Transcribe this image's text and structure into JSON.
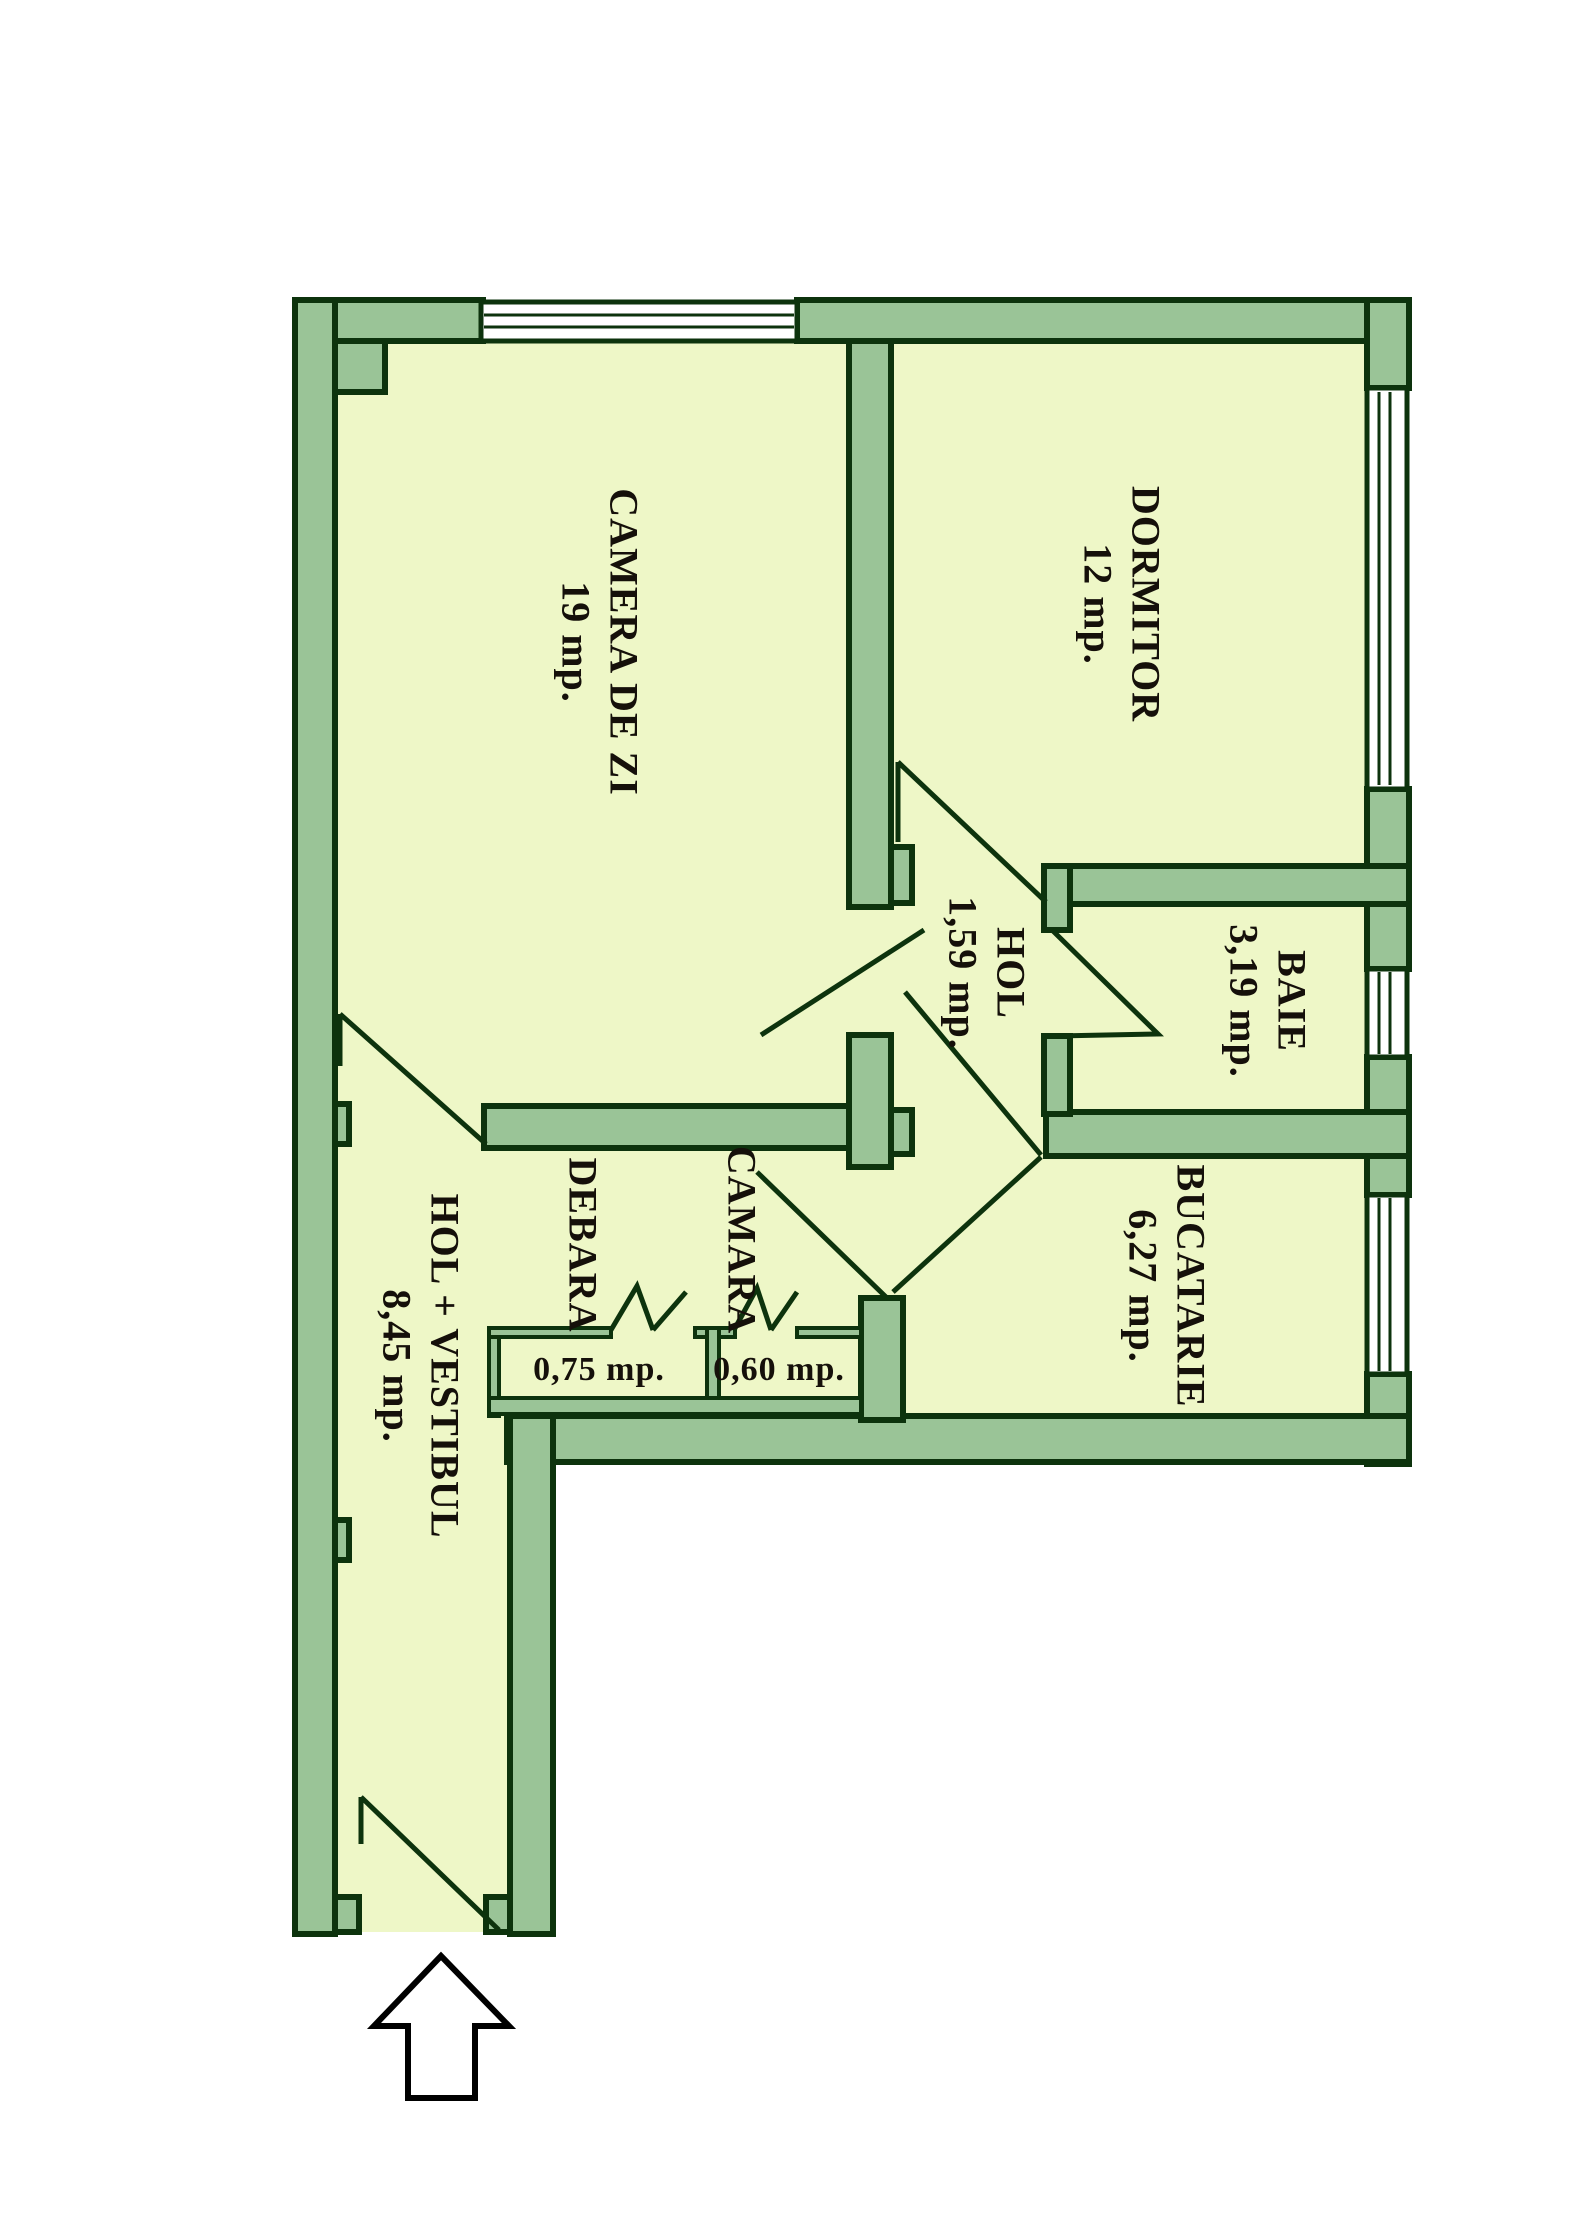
{
  "plan": {
    "type": "apartment-floor-plan",
    "rooms": [
      {
        "name": "CAMERA DE ZI",
        "area": "19 mp."
      },
      {
        "name": "DORMITOR",
        "area": "12 mp."
      },
      {
        "name": "HOL",
        "area": "1,59 mp."
      },
      {
        "name": "BAIE",
        "area": "3,19 mp."
      },
      {
        "name": "BUCATARIE",
        "area": "6,27 mp."
      },
      {
        "name": "DEBARA",
        "area": "0,75 mp."
      },
      {
        "name": "CAMARA",
        "area": "0,60 mp."
      },
      {
        "name": "HOL + VESTIBUL",
        "area": "8,45 mp."
      }
    ],
    "icons": {
      "entrance": "arrow-up-icon"
    },
    "colors": {
      "wall": "#9ac497",
      "outline": "#0d330d",
      "floor": "#eef7c7",
      "window": "#ffffff",
      "text": "#15100a",
      "arrow": "#000000"
    }
  }
}
